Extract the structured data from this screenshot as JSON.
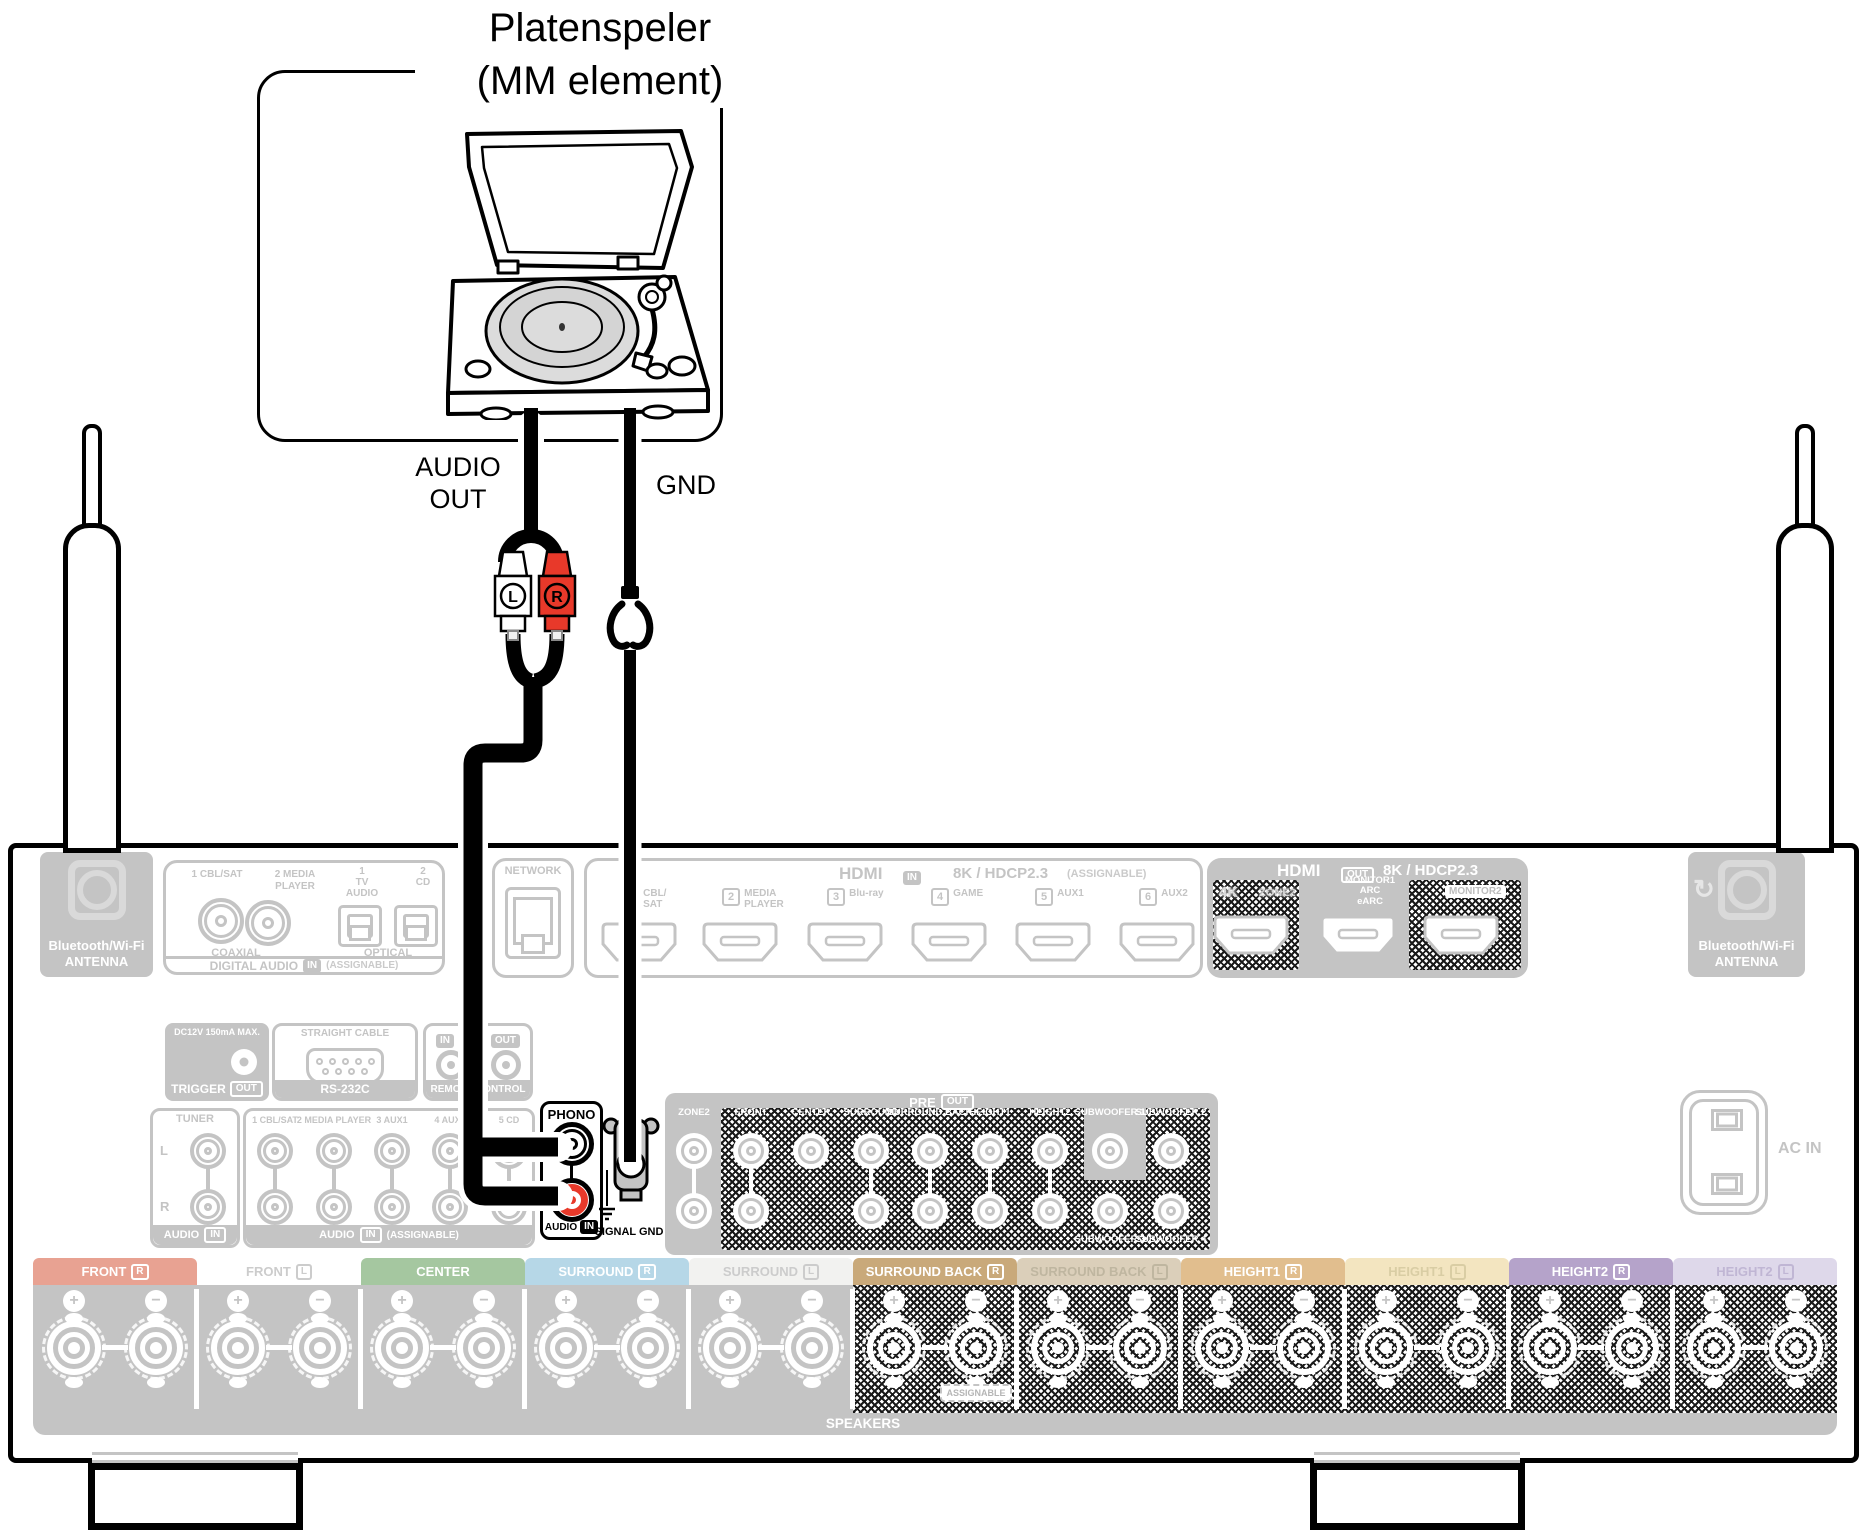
{
  "title": {
    "line1": "Platenspeler",
    "line2": "(MM element)"
  },
  "connection": {
    "audio_out_label": "AUDIO\nOUT",
    "gnd_label": "GND",
    "rca_left": "L",
    "rca_right": "R",
    "rca_red_color": "#e8392a"
  },
  "colors": {
    "panel_gray": "#c4c4c4",
    "highlight_black": "#000000"
  },
  "panel": {
    "antenna": {
      "line1": "Bluetooth/Wi-Fi",
      "line2": "ANTENNA"
    },
    "digital_audio": {
      "inputs": [
        "1 CBL/SAT",
        "2 MEDIA\nPLAYER",
        "1\nTV\nAUDIO",
        "2\nCD"
      ],
      "coaxial": "COAXIAL",
      "optical": "OPTICAL",
      "title": "DIGITAL AUDIO",
      "in_badge": "IN",
      "assignable": "(ASSIGNABLE)"
    },
    "network": {
      "label": "NETWORK"
    },
    "hdmi_in": {
      "title": "HDMI",
      "in_badge": "IN",
      "spec": "8K / HDCP2.3",
      "assignable": "(ASSIGNABLE)",
      "ports": [
        {
          "num": "1",
          "label": "CBL/\nSAT"
        },
        {
          "num": "2",
          "label": "MEDIA\nPLAYER"
        },
        {
          "num": "3",
          "label": "Blu-ray"
        },
        {
          "num": "4",
          "label": "GAME"
        },
        {
          "num": "5",
          "label": "AUX1"
        },
        {
          "num": "6",
          "label": "AUX2"
        }
      ]
    },
    "hdmi_out": {
      "title": "HDMI",
      "out_badge": "OUT",
      "spec": "8K / HDCP2.3",
      "port1_left": "4K",
      "port1_right": "ZONE2",
      "port2": "MONITOR1\nARC\neARC",
      "port3": "MONITOR2"
    },
    "trigger": {
      "top": "DC12V 150mA MAX.",
      "label": "TRIGGER",
      "badge": "OUT"
    },
    "rs232": {
      "top": "STRAIGHT CABLE",
      "label": "RS-232C"
    },
    "remote": {
      "in_badge": "IN",
      "out_badge": "OUT",
      "label": "REMOTE CONTROL"
    },
    "tuner": {
      "label": "TUNER",
      "l": "L",
      "r": "R",
      "audio": "AUDIO",
      "in_badge": "IN"
    },
    "analog_in": {
      "columns": [
        "1 CBL/SAT",
        "2 MEDIA PLAYER",
        "3 AUX1",
        "4 AUX2",
        "5 CD"
      ],
      "audio": "AUDIO",
      "in_badge": "IN",
      "assignable": "(ASSIGNABLE)"
    },
    "phono": {
      "label": "PHONO",
      "audio": "AUDIO",
      "in_badge": "IN"
    },
    "signal_gnd": {
      "label": "SIGNAL GND"
    },
    "pre_out": {
      "title": "PRE",
      "badge": "OUT",
      "columns": [
        "ZONE2",
        "FRONT",
        "CENTER",
        "SURROUND",
        "SURROUND BACK",
        "HEIGHT1",
        "HEIGHT2",
        "SUBWOOFER 1",
        "SUBWOOFER 2"
      ],
      "bottom": [
        "SUBWOOFER 3",
        "SUBWOOFER 4"
      ]
    },
    "ac_in": {
      "label": "AC IN"
    },
    "speakers": {
      "bands": [
        {
          "label": "FRONT",
          "ch": "R",
          "color": "#e8a292",
          "text": "#ffffff"
        },
        {
          "label": "FRONT",
          "ch": "L",
          "color": "#ffffff",
          "text": "#cccccc"
        },
        {
          "label": "CENTER",
          "ch": "",
          "color": "#a5c7a0",
          "text": "#ffffff"
        },
        {
          "label": "SURROUND",
          "ch": "R",
          "color": "#b6d7e7",
          "text": "#ffffff"
        },
        {
          "label": "SURROUND",
          "ch": "L",
          "color": "#f2f2f0",
          "text": "#cccccc"
        },
        {
          "label": "SURROUND BACK",
          "ch": "R",
          "color": "#c9a97a",
          "text": "#ffffff"
        },
        {
          "label": "SURROUND BACK",
          "ch": "L",
          "color": "#dbcfba",
          "text": "#bfb6a0"
        },
        {
          "label": "HEIGHT1",
          "ch": "R",
          "color": "#e1be8e",
          "text": "#ffffff"
        },
        {
          "label": "HEIGHT1",
          "ch": "L",
          "color": "#f3e5c0",
          "text": "#d9cda4"
        },
        {
          "label": "HEIGHT2",
          "ch": "R",
          "color": "#b5a3ca",
          "text": "#ffffff"
        },
        {
          "label": "HEIGHT2",
          "ch": "L",
          "color": "#ded8ea",
          "text": "#c0b6d4"
        }
      ],
      "assignable": "ASSIGNABLE",
      "footer": "SPEAKERS"
    }
  }
}
